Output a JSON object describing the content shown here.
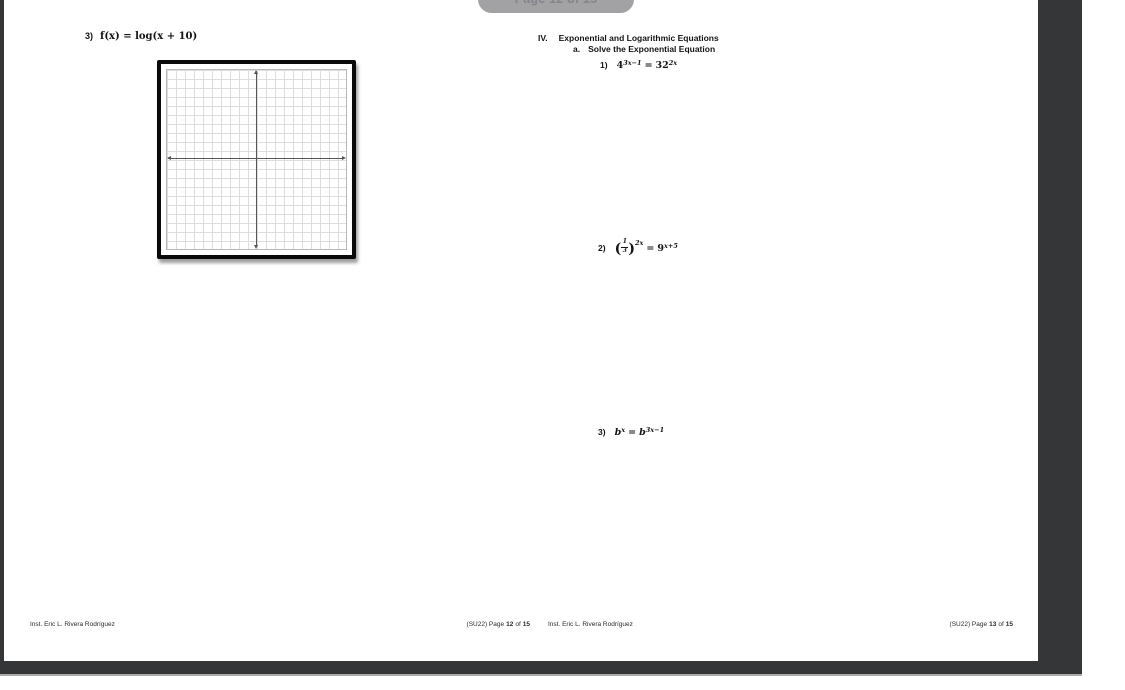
{
  "viewer": {
    "page_badge_label": "Page 12 of 15",
    "colors": {
      "window_background": "#343637",
      "page_background": "#ffffff",
      "badge_background": "#a2a2a4",
      "badge_text": "#84848c",
      "grid_line": "#dedede",
      "axis_line": "#565656"
    }
  },
  "left_page": {
    "problem_log": {
      "label": "3)",
      "formula": "f(x) = log(x + 10)"
    },
    "graph": {
      "description": "blank coordinate grid with x and y axes",
      "grid_cells": "20x20"
    },
    "footer": {
      "author": "Inst. Eric L. Rivera Rodríguez",
      "term": "(SU22) Page",
      "page_num": "12",
      "of": "of",
      "total": "15"
    }
  },
  "right_page": {
    "section": {
      "numeral": "IV.",
      "title": "Exponential and Logarithmic Equations"
    },
    "subsection": {
      "label": "a.",
      "title": "Solve the Exponential Equation"
    },
    "problems": {
      "p1": {
        "label": "1)",
        "lhs_base": "4",
        "lhs_sup": "3x−1",
        "equals": "=",
        "rhs_base": "32",
        "rhs_sup": "2x"
      },
      "p2": {
        "label": "2)",
        "open_paren": "(",
        "frac_num": "1",
        "frac_den": "3",
        "close_paren": ")",
        "lhs_sup": "2x",
        "equals": "=",
        "rhs_base": "9",
        "rhs_sup": "x+5"
      },
      "p3": {
        "label": "3)",
        "lhs_base": "b",
        "lhs_sup": "x",
        "equals": "=",
        "rhs_base": "b",
        "rhs_sup": "3x−1"
      }
    },
    "footer": {
      "author": "Inst. Eric L. Rivera Rodríguez",
      "term": "(SU22) Page",
      "page_num": "13",
      "of": "of",
      "total": "15"
    }
  }
}
